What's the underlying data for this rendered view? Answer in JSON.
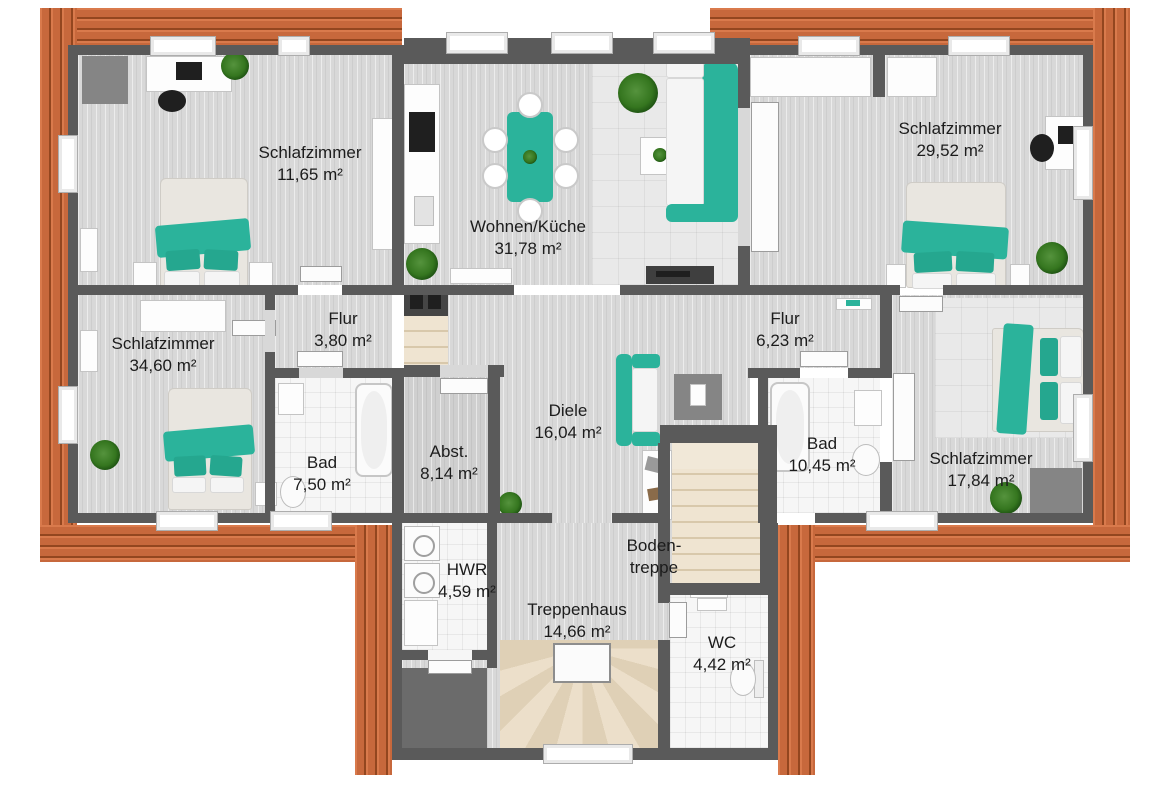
{
  "plan": {
    "type": "floor-plan",
    "language": "de",
    "area_unit": "m²"
  },
  "rooms": [
    {
      "id": "schlafzimmer-top-left",
      "name": "Schlafzimmer",
      "area": "11,65 m²"
    },
    {
      "id": "wohnen-kueche",
      "name": "Wohnen/Küche",
      "area": "31,78 m²"
    },
    {
      "id": "schlafzimmer-top-right",
      "name": "Schlafzimmer",
      "area": "29,52 m²"
    },
    {
      "id": "flur-left",
      "name": "Flur",
      "area": "3,80 m²"
    },
    {
      "id": "schlafzimmer-left",
      "name": "Schlafzimmer",
      "area": "34,60 m²"
    },
    {
      "id": "flur-right",
      "name": "Flur",
      "area": "6,23 m²"
    },
    {
      "id": "diele",
      "name": "Diele",
      "area": "16,04 m²"
    },
    {
      "id": "bad-left",
      "name": "Bad",
      "area": "7,50 m²"
    },
    {
      "id": "abstellraum",
      "name": "Abst.",
      "area": "8,14 m²"
    },
    {
      "id": "bad-right",
      "name": "Bad",
      "area": "10,45 m²"
    },
    {
      "id": "schlafzimmer-right",
      "name": "Schlafzimmer",
      "area": "17,84 m²"
    },
    {
      "id": "bodentreppe",
      "name": "Boden-treppe",
      "area": ""
    },
    {
      "id": "hwr",
      "name": "HWR",
      "area": "4,59 m²"
    },
    {
      "id": "treppenhaus",
      "name": "Treppenhaus",
      "area": "14,66 m²"
    },
    {
      "id": "wc",
      "name": "WC",
      "area": "4,42 m²"
    }
  ],
  "colors": {
    "roof_tiles": "#c7683c",
    "walls": "#5a5a5a",
    "accent_teal": "#2bb39b",
    "stairs_beige": "#e9dcc6",
    "floor_gray": "#d8d8d8"
  }
}
